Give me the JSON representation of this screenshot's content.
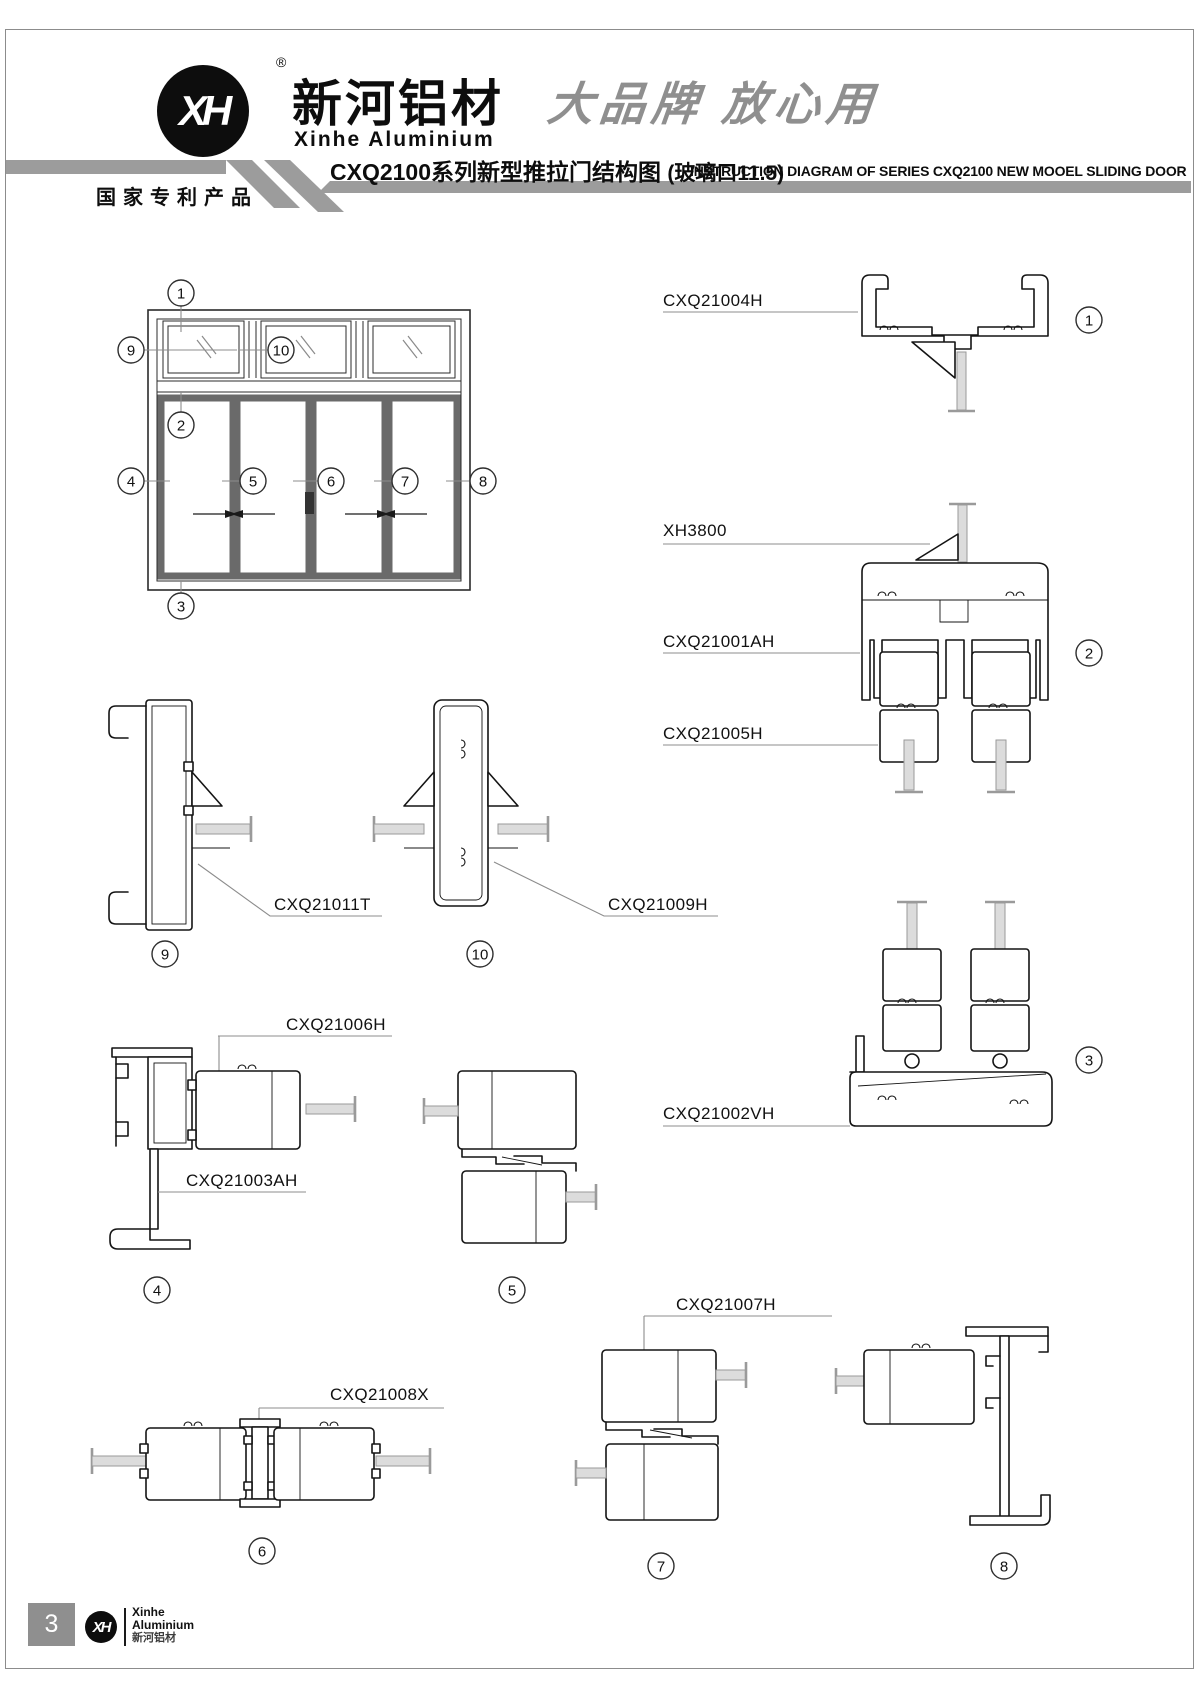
{
  "header": {
    "logo_text": "XH",
    "registered_mark": "®",
    "brand_cn": "新河铝材",
    "brand_en": "Xinhe Aluminium",
    "slogan": "大品牌 放心用",
    "patent_badge": "国家专利产品",
    "title_cn": "CXQ2100系列新型推拉门结构图",
    "title_note": "(玻璃口11.5)",
    "title_en": "INSTRUCTION DIAGRAM OF SERIES CXQ2100 NEW MOOEL SLIDING DOOR"
  },
  "diagram": {
    "numbers": {
      "n1": "1",
      "n2": "2",
      "n3": "3",
      "n4": "4",
      "n5": "5",
      "n6": "6",
      "n7": "7",
      "n8": "8",
      "n9": "9",
      "n10": "10"
    },
    "labels": {
      "top_frame": "CXQ21004H",
      "glazing_bead": "XH3800",
      "transom_frame": "CXQ21001AH",
      "door_top_rail": "CXQ21005H",
      "bottom_sill": "CXQ21002VH",
      "side_jamb_transom": "CXQ21011T",
      "transom_mullion": "CXQ21009H",
      "door_stile": "CXQ21006H",
      "side_jamb": "CXQ21003AH",
      "center_connector": "CXQ21008X",
      "meeting_stile": "CXQ21007H"
    }
  },
  "footer": {
    "page_number": "3",
    "logo_text": "XH",
    "brand_line1": "Xinhe",
    "brand_line2": "Aluminium",
    "brand_line3": "新河铝材"
  }
}
